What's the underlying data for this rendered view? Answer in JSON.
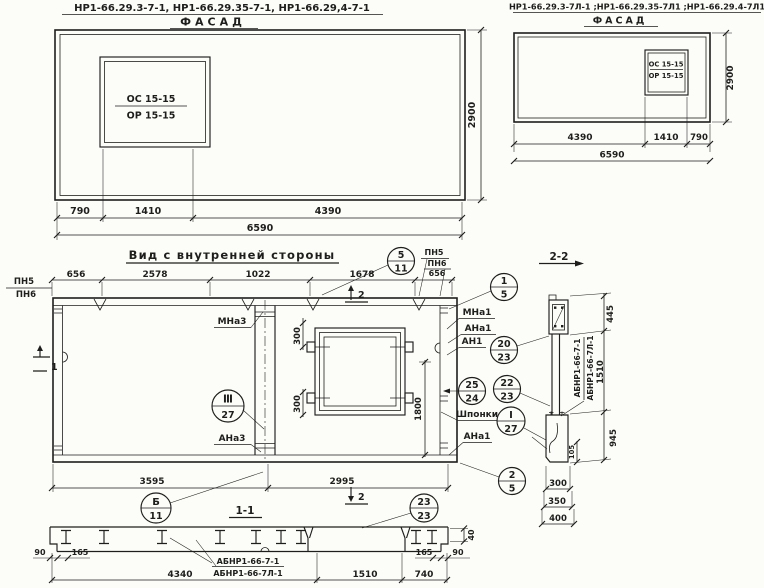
{
  "meta": {
    "background": "#fcfcf9",
    "ink": "#1e1e1c"
  },
  "facade_left": {
    "title": "НР1-66.29.3-7-1, НР1-66.29.35-7-1, НР1-66.29,4-7-1",
    "view_label": "ФАСАД",
    "window_mark_top": "ОС 15-15",
    "window_mark_bottom": "ОР 15-15",
    "dims": {
      "left": "790",
      "mid": "1410",
      "right": "4390",
      "total": "6590",
      "height": "2900"
    }
  },
  "facade_right": {
    "title": "НР1-66.29.3-7Л-1 ;НР1-66.29.35-7Л1 ;НР1-66.29.4-7Л1",
    "view_label": "ФАСАД",
    "window_mark_top": "ОС 15-15",
    "window_mark_bottom": "ОР 15-15",
    "dims": {
      "left": "4390",
      "mid": "1410",
      "right": "790",
      "total": "6590",
      "height": "2900"
    }
  },
  "inner_view": {
    "title": "Вид с внутренней стороны",
    "top_dims": [
      "656",
      "2578",
      "1022",
      "1678",
      "656"
    ],
    "left_labels": {
      "pn5": "ПН5",
      "pn6": "ПН6"
    },
    "right_labels": {
      "pn5": "ПН5",
      "pn6": "ПН6"
    },
    "window_dims": {
      "top": "300",
      "bottom": "300",
      "height": "1800"
    },
    "bottom_dims": {
      "left": "3595",
      "right": "2995"
    },
    "part_labels": {
      "mna3": "МНа3",
      "ana3": "АНа3",
      "mna1": "МНа1",
      "ana1": "АНа1",
      "an1": "АН1",
      "shponki": "Шпонки",
      "ana1_b": "АНа1"
    },
    "section_marks": {
      "s1": "1",
      "s2_top": "2",
      "s2_bottom": "2"
    },
    "section_label": "1-1",
    "callouts": {
      "c5_11": {
        "top": "5",
        "bottom": "11"
      },
      "c1_5": {
        "top": "1",
        "bottom": "5"
      },
      "c20_23": {
        "top": "20",
        "bottom": "23"
      },
      "c25_24": {
        "top": "25",
        "bottom": "24"
      },
      "c22_23": {
        "top": "22",
        "bottom": "23"
      },
      "cI_27": {
        "top": "I",
        "bottom": "27"
      },
      "cIII_27": {
        "top": "Ⅲ",
        "bottom": "27"
      },
      "c2_5": {
        "top": "2",
        "bottom": "5"
      },
      "cB_11": {
        "top": "Б",
        "bottom": "11"
      },
      "c23_23": {
        "top": "23",
        "bottom": "23"
      }
    }
  },
  "section_1_1": {
    "label_line1": "АБНР1-66-7-1",
    "label_line2": "АБНР1-66-7Л-1",
    "dims": {
      "d90_l": "90",
      "d165_l": "165",
      "d4340": "4340",
      "d1510": "1510",
      "d740": "740",
      "d165_r": "165",
      "d90_r": "90",
      "d40": "40"
    }
  },
  "section_2_2": {
    "title": "2-2",
    "rot_labels": {
      "line1": "АБНР1-66-7-1",
      "line2": "АБНР1-66-7Л-1",
      "dim1510": "1510"
    },
    "dims": {
      "d445": "445",
      "d945": "945",
      "d105": "105",
      "d300": "300",
      "d350": "350",
      "d400": "400"
    }
  }
}
